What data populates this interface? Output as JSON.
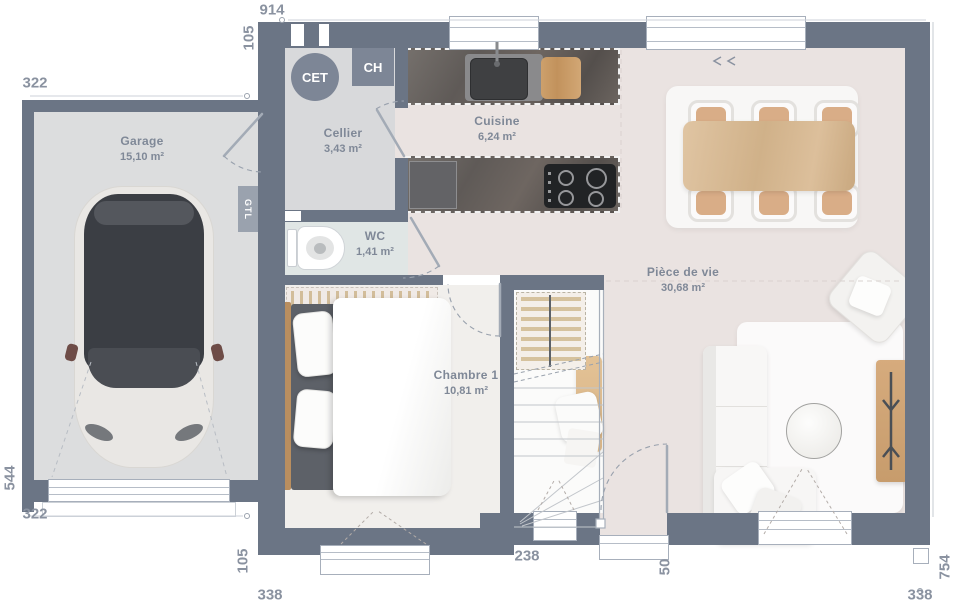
{
  "plan": {
    "rooms": [
      {
        "label": "Garage",
        "area": "15,10 m²"
      },
      {
        "label": "Cellier",
        "area": "3,43 m²"
      },
      {
        "label": "Cuisine",
        "area": "6,24 m²"
      },
      {
        "label": "WC",
        "area": "1,41 m²"
      },
      {
        "label": "Pièce de vie",
        "area": "30,68 m²"
      },
      {
        "label": "Chambre 1",
        "area": "10,81 m²"
      }
    ],
    "equipment": {
      "water_heater": "CET",
      "boiler": "CH",
      "electrical_box": "GTL"
    },
    "dimensions": {
      "overall_width": "914",
      "front_offset": "105",
      "garage_width_top": "322",
      "garage_depth": "544",
      "garage_width_bottom": "322",
      "bedroom_offset": "105",
      "bedroom_width": "338",
      "entry_width": "238",
      "door_width": "50",
      "living_width": "338",
      "right_depth": "754"
    },
    "colors": {
      "wall": "#6b7585",
      "floor": "#eae3e1",
      "garage": "#dcddde",
      "cellier": "#d8d9db",
      "wc": "#e0e6e5",
      "bedroom": "#f1efec",
      "stairs": "#fbfbfa",
      "wood": "#d3ad83",
      "badge": "#7d8696",
      "gtl": "#9aa2ae",
      "label": "#7f8897",
      "dim": "#8a92a0",
      "car": "#3b3e44"
    }
  }
}
